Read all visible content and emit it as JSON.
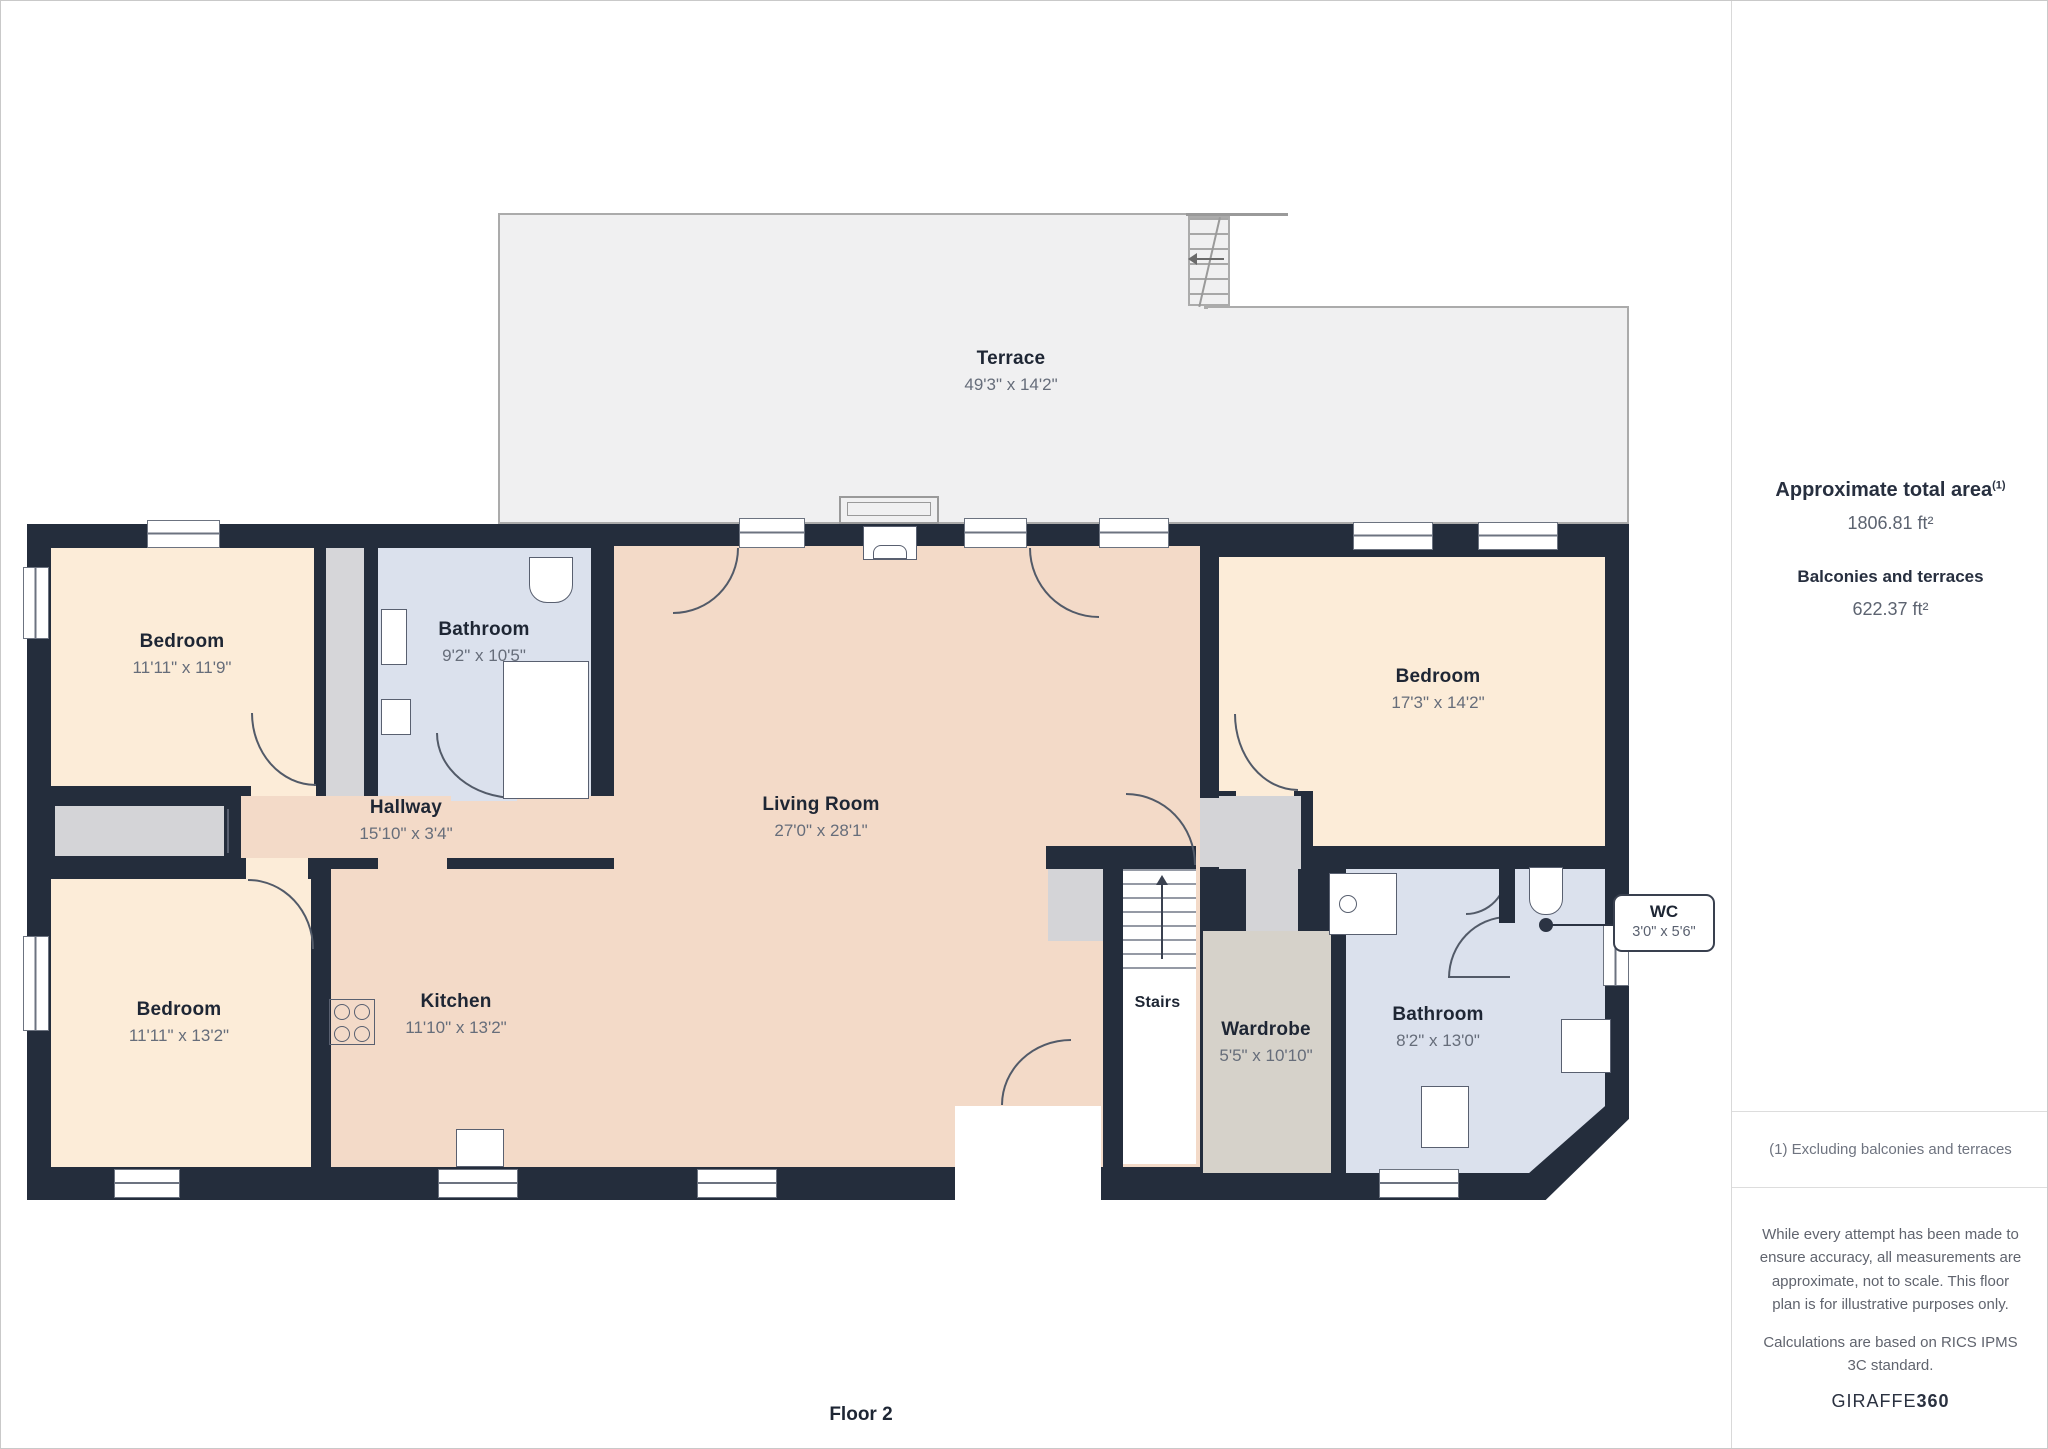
{
  "page": {
    "floor_label": "Floor 2"
  },
  "rooms": {
    "terrace": {
      "name": "Terrace",
      "dims": "49'3\" x 14'2\""
    },
    "bedroom_top_left": {
      "name": "Bedroom",
      "dims": "11'11\" x 11'9\""
    },
    "bathroom_top_left": {
      "name": "Bathroom",
      "dims": "9'2\" x 10'5\""
    },
    "hallway": {
      "name": "Hallway",
      "dims": "15'10\" x 3'4\""
    },
    "living_room": {
      "name": "Living Room",
      "dims": "27'0\" x 28'1\""
    },
    "bedroom_bottom_left": {
      "name": "Bedroom",
      "dims": "11'11\" x 13'2\""
    },
    "kitchen": {
      "name": "Kitchen",
      "dims": "11'10\" x 13'2\""
    },
    "bedroom_right": {
      "name": "Bedroom",
      "dims": "17'3\" x 14'2\""
    },
    "stairs": {
      "name": "Stairs"
    },
    "wardrobe": {
      "name": "Wardrobe",
      "dims": "5'5\" x 10'10\""
    },
    "bathroom_right": {
      "name": "Bathroom",
      "dims": "8'2\" x 13'0\""
    },
    "wc": {
      "name": "WC",
      "dims": "3'0\" x 5'6\""
    }
  },
  "sidebar": {
    "total_area_label": "Approximate total area",
    "total_area_note_ref": "(1)",
    "total_area_value": "1806.81 ft²",
    "balconies_label": "Balconies and terraces",
    "balconies_value": "622.37 ft²",
    "note": "(1) Excluding balconies and terraces",
    "disclaimer_line1": "While every attempt has been made to ensure accuracy, all measurements are approximate, not to scale. This floor plan is for illustrative purposes only.",
    "disclaimer_line2": "Calculations are based on RICS IPMS 3C standard.",
    "brand": "GIRAFFE",
    "brand_bold": "360"
  },
  "colors": {
    "wall": "#242d3c",
    "bedroom_fill": "#fcecd8",
    "living_fill": "#f3dac8",
    "bathroom_fill": "#dbe1ed",
    "wardrobe_fill": "#d6d2ca",
    "closet_fill": "#d6d6d9",
    "terrace_fill": "#f0f0f1",
    "text_dark": "#1e2634",
    "text_dim": "#666d7a"
  }
}
